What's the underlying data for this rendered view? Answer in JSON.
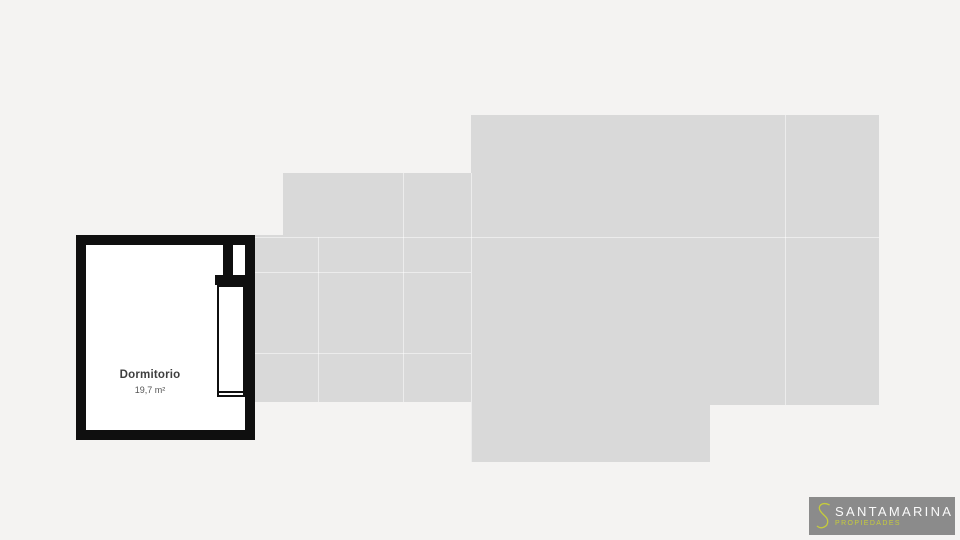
{
  "page": {
    "background_color": "#f4f3f2"
  },
  "floorplan": {
    "silhouette_color": "#d9d9d9",
    "wall_color": "#0f0f0f",
    "room_fill_color": "#ffffff",
    "room": {
      "label": "Dormitorio",
      "area": "19,7 m²"
    }
  },
  "logo": {
    "monogram": "S",
    "brand": "SANTAMARINA",
    "tagline": "PROPIEDADES",
    "background_color": "#8b8b8b",
    "accent_color": "#c6cc3c",
    "brand_text_color": "#fafafa"
  }
}
